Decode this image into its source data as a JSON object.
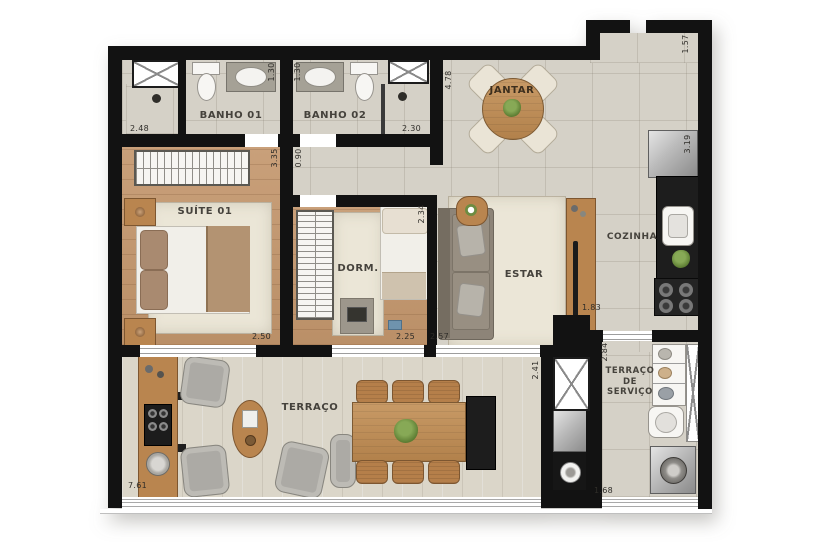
{
  "plan_title": "apartment-floor-plan",
  "rooms": {
    "banho01": "BANHO 01",
    "banho02": "BANHO 02",
    "suite01": "SUÍTE 01",
    "dorm": "DORM.",
    "estar": "ESTAR",
    "jantar": "JANTAR",
    "cozinha": "COZINHA",
    "terraco": "TERRAÇO",
    "terraco_servico_line1": "TERRAÇO DE",
    "terraco_servico_line2": "SERVIÇO"
  },
  "dimensions": {
    "suite_shower_width": "2.48",
    "banho01_depth": "1.30",
    "banho02_depth": "1.30",
    "banho02_shower_width": "2.30",
    "suite_right_depth": "3.35",
    "hall_width": "0.90",
    "jantar_depth": "4.78",
    "entry_width": "1.57",
    "cozinha_depth": "3.19",
    "suite_width": "2.50",
    "dorm_width": "2.25",
    "dorm_depth": "2.34",
    "estar_width": "2.57",
    "cozinha_opening": "1.83",
    "servico_depth": "2.84",
    "terraco_depth": "2.41",
    "terraco_width": "7.61",
    "servico_width": "1.68"
  },
  "colors": {
    "wall": "#121212",
    "tile_floor": "#d5d1c7",
    "wood_floor": "#c49a74",
    "rug": "#ebe6d7",
    "wood_furniture": "#b9854f",
    "granite": "#1d1d1d",
    "gray_chair": "#acaaa5",
    "plant": "#5d7d33"
  }
}
